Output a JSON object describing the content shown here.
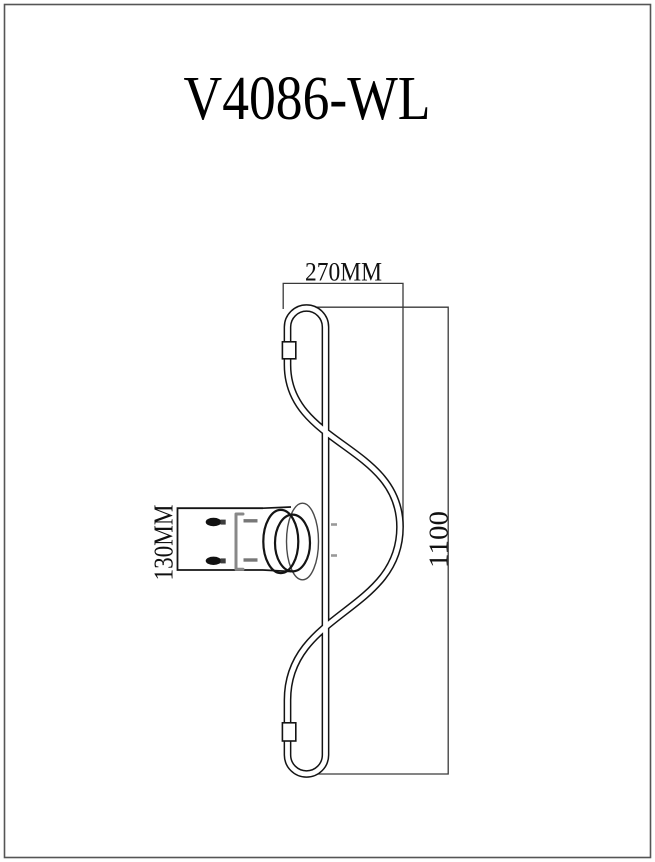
{
  "page": {
    "title": "V4086-WL"
  },
  "drawing": {
    "dimensions": {
      "width": "270MM",
      "height": "1100",
      "mount_height": "130MM"
    }
  },
  "colors": {
    "line": "#141414",
    "dimension_line": "#3a3a3a",
    "hardware_gray": "#888888",
    "page_border": "#555555",
    "background": "#ffffff"
  }
}
